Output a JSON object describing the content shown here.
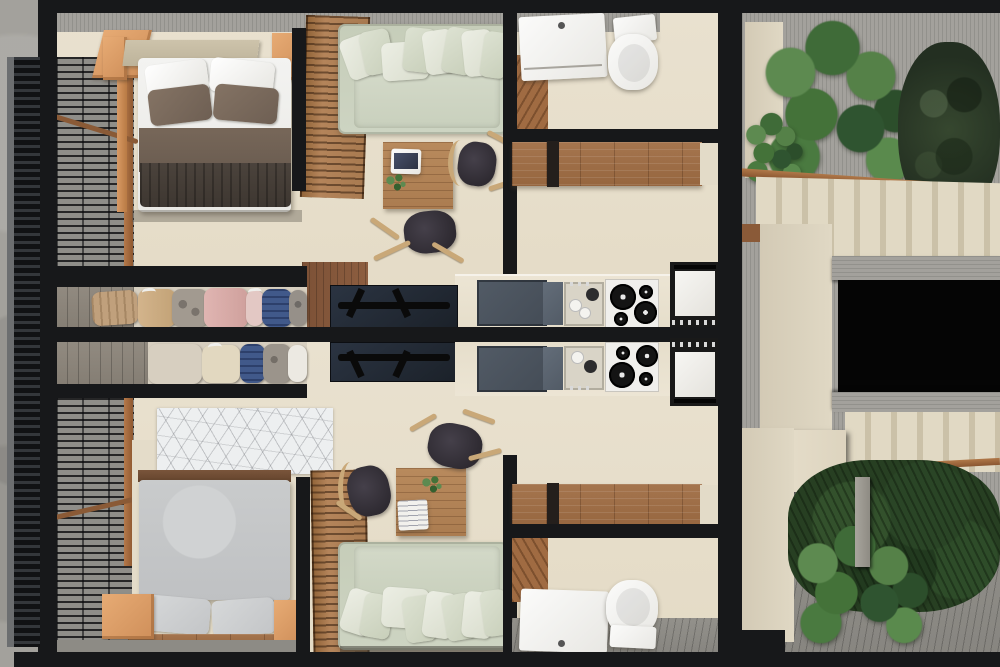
{
  "scene": {
    "title": "Top-down architectural render: two mirrored micro-apartments flanking a stair courtyard",
    "view": "axonometric top-down 3D floor plan, no text labels",
    "units": [
      {
        "name": "upper-studio",
        "rooms": [
          {
            "name": "balcony",
            "items": [
              "metal-grate-deck",
              "dark-louver-screen",
              "timber-rail",
              "orange-window-frame"
            ]
          },
          {
            "name": "bedroom",
            "items": [
              "double-bed",
              "white-pillow-pair",
              "brown-pillow-pair",
              "brown-blanket",
              "dark-folded-throw",
              "tan-headboard",
              "nightstand-left",
              "nightstand-right",
              "louvered-timber-door"
            ]
          },
          {
            "name": "living-room",
            "items": [
              "sage-sofa-with-cushions",
              "timber-louver-screen",
              "wood-dining-table",
              "laptop",
              "table-plant",
              "dark-chair-right",
              "dark-chair-front"
            ]
          },
          {
            "name": "wardrobe-closet",
            "items": [
              "duffel-bag",
              "tan-jacket",
              "patterned-shirt",
              "pink-blouse",
              "blush-top",
              "denim-stack",
              "gray-shirt"
            ]
          },
          {
            "name": "kitchen",
            "items": [
              "slate-double-sink",
              "dish-tray",
              "gas-hob-4-burners",
              "oven",
              "tv-on-walnut-panel",
              "cream-counter"
            ]
          },
          {
            "name": "corridor",
            "items": [
              "timber-storage-bench"
            ]
          },
          {
            "name": "bathroom",
            "items": [
              "white-vanity-sink",
              "toilet",
              "timber-shower-deck",
              "concrete-wall-band"
            ]
          }
        ]
      },
      {
        "name": "lower-studio",
        "mirrored": true,
        "rooms": [
          {
            "name": "balcony",
            "items": [
              "metal-grate-deck",
              "dark-louver-screen",
              "timber-rail"
            ]
          },
          {
            "name": "bedroom",
            "items": [
              "gray-double-bed",
              "gray-pillow-pair",
              "geometric-line-rug",
              "timber-headboard-strip",
              "nightstand-left",
              "nightstand-right",
              "louvered-timber-door"
            ]
          },
          {
            "name": "living-room",
            "items": [
              "sage-sofa-with-cushions",
              "wood-dining-table",
              "book",
              "table-plant",
              "dark-chair-top",
              "dark-chair-left"
            ]
          },
          {
            "name": "wardrobe-closet",
            "items": [
              "beige-coat",
              "cream-coat",
              "denim-stack",
              "patterned-shirt",
              "white-shirt"
            ]
          },
          {
            "name": "kitchen",
            "items": [
              "slate-double-sink",
              "dish-tray",
              "gas-hob-4-burners",
              "oven",
              "tv-on-walnut-panel",
              "cream-counter"
            ]
          },
          {
            "name": "corridor",
            "items": [
              "timber-storage-bench"
            ]
          },
          {
            "name": "bathroom",
            "items": [
              "white-vanity-sink",
              "toilet",
              "timber-shower-deck",
              "gray-floor-strip"
            ]
          }
        ]
      }
    ],
    "courtyard": {
      "items": [
        "monstera-planting",
        "dark-tree-canopy",
        "upper-stair-flight",
        "timber-handrail",
        "concrete-edge-beams",
        "black-floor-void",
        "lower-stair-flight",
        "fern-bed",
        "gray-timber-deck",
        "concrete-post",
        "beige-walls"
      ]
    }
  },
  "colors": {
    "wall_black": "#17181a",
    "concrete": "#a3a19c",
    "deck_gray": "#8f8e89",
    "floor_beige": "#e7dfcc",
    "wall_beige": "#ddd4c0",
    "wood_louver": "#a87a50",
    "wood_frame_orange": "#dd9f6b",
    "wood_walnut": "#8a5f41",
    "sofa_sage": "#cbd2bf",
    "bed_white": "#f1f1ef",
    "pillow_brown": "#7d6c5f",
    "blanket_brown": "#6f6158",
    "blanket_dark": "#453e38",
    "headboard_tan": "#c6bca4",
    "bed_gray": "#c7c9ca",
    "rug_white": "#edeff0",
    "sink_slate": "#4a525c",
    "appliance_white": "#f2f1ee",
    "chair_dark": "#352f33",
    "chair_wood": "#c9a878",
    "tv_dark": "#252c35",
    "plant_green": "#4c7a43",
    "tree_dark": "#2c3a2b",
    "denim_blue": "#41598a",
    "cloth_pink": "#d6aba8",
    "cloth_tan": "#c7a87f",
    "stair_beige": "#e0d7c2",
    "void_black": "#050505"
  }
}
